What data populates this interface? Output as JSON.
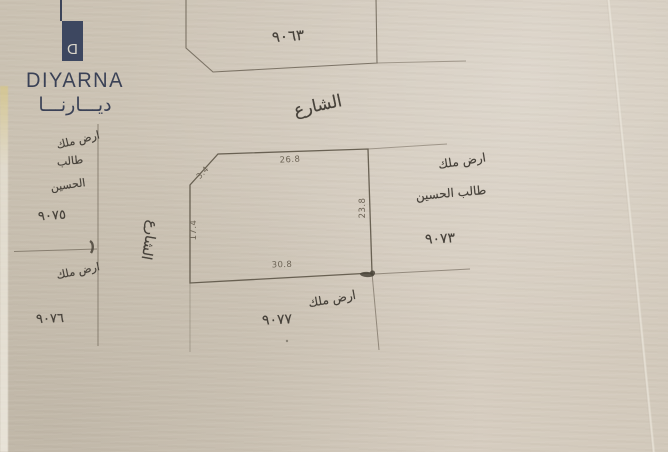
{
  "logo": {
    "monogram": "D",
    "wordmark": "DIYARNA",
    "arabic_wordmark": "ديـــارنـــا",
    "brand_color": "#3a4156"
  },
  "plan": {
    "street_top_label": "الشارع",
    "street_left_label": "الشارع",
    "plot_top": {
      "number": "٩٠٦٣"
    },
    "plot_center": {
      "dim_top": "26.8",
      "dim_corner": "3.4",
      "dim_left": "17.4",
      "dim_right": "23.8",
      "dim_bottom": "30.8"
    },
    "plot_right": {
      "owner_line1": "ارض ملك",
      "owner_line2": "طالب الحسين",
      "number": "٩٠٧٣"
    },
    "plot_left_upper": {
      "owner_line1": "ارض ملك",
      "owner_line2": "طالب",
      "owner_line3": "الحسين",
      "number": "٩٠٧٥"
    },
    "plot_left_lower": {
      "owner_line1": "ارض ملك",
      "number": "٩٠٧٦"
    },
    "plot_bottom": {
      "owner_line1": "ارض ملك",
      "number": "٩٠٧٧"
    }
  },
  "colors": {
    "paper": "#cfc6b8",
    "ink_lines": "#5d5547",
    "handwriting": "#46413a",
    "brand_navy": "#3a4156"
  }
}
